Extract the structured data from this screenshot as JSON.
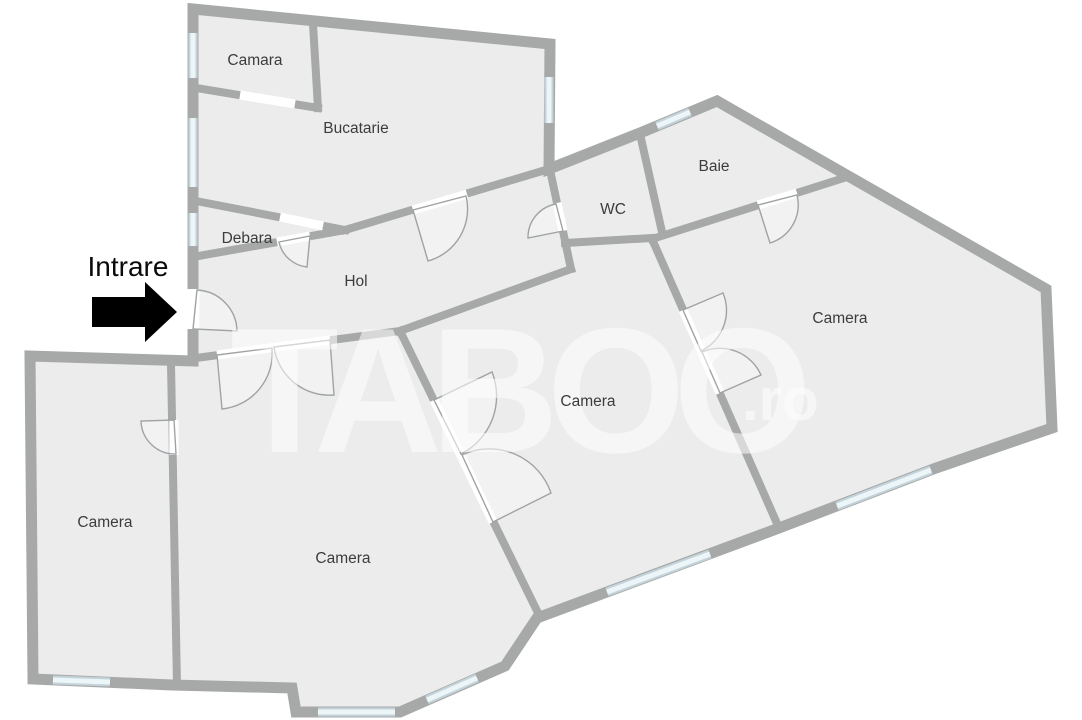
{
  "plan": {
    "entrance_label": "Intrare",
    "watermark": {
      "text": "TABOO",
      "suffix": ".ro"
    },
    "rooms": [
      {
        "id": "camara",
        "label": "Camara"
      },
      {
        "id": "bucatarie",
        "label": "Bucatarie"
      },
      {
        "id": "debara",
        "label": "Debara"
      },
      {
        "id": "hol",
        "label": "Hol"
      },
      {
        "id": "wc",
        "label": "WC"
      },
      {
        "id": "baie",
        "label": "Baie"
      },
      {
        "id": "camera-right",
        "label": "Camera"
      },
      {
        "id": "camera-middle",
        "label": "Camera"
      },
      {
        "id": "camera-bottom",
        "label": "Camera"
      },
      {
        "id": "camera-left",
        "label": "Camera"
      }
    ],
    "colors": {
      "background": "#ffffff",
      "wall": "#a7a9a8",
      "room_fill": "#ececec",
      "window": "#dce8ec",
      "label_text": "#3c3c3c",
      "arrow": "#000000"
    }
  }
}
